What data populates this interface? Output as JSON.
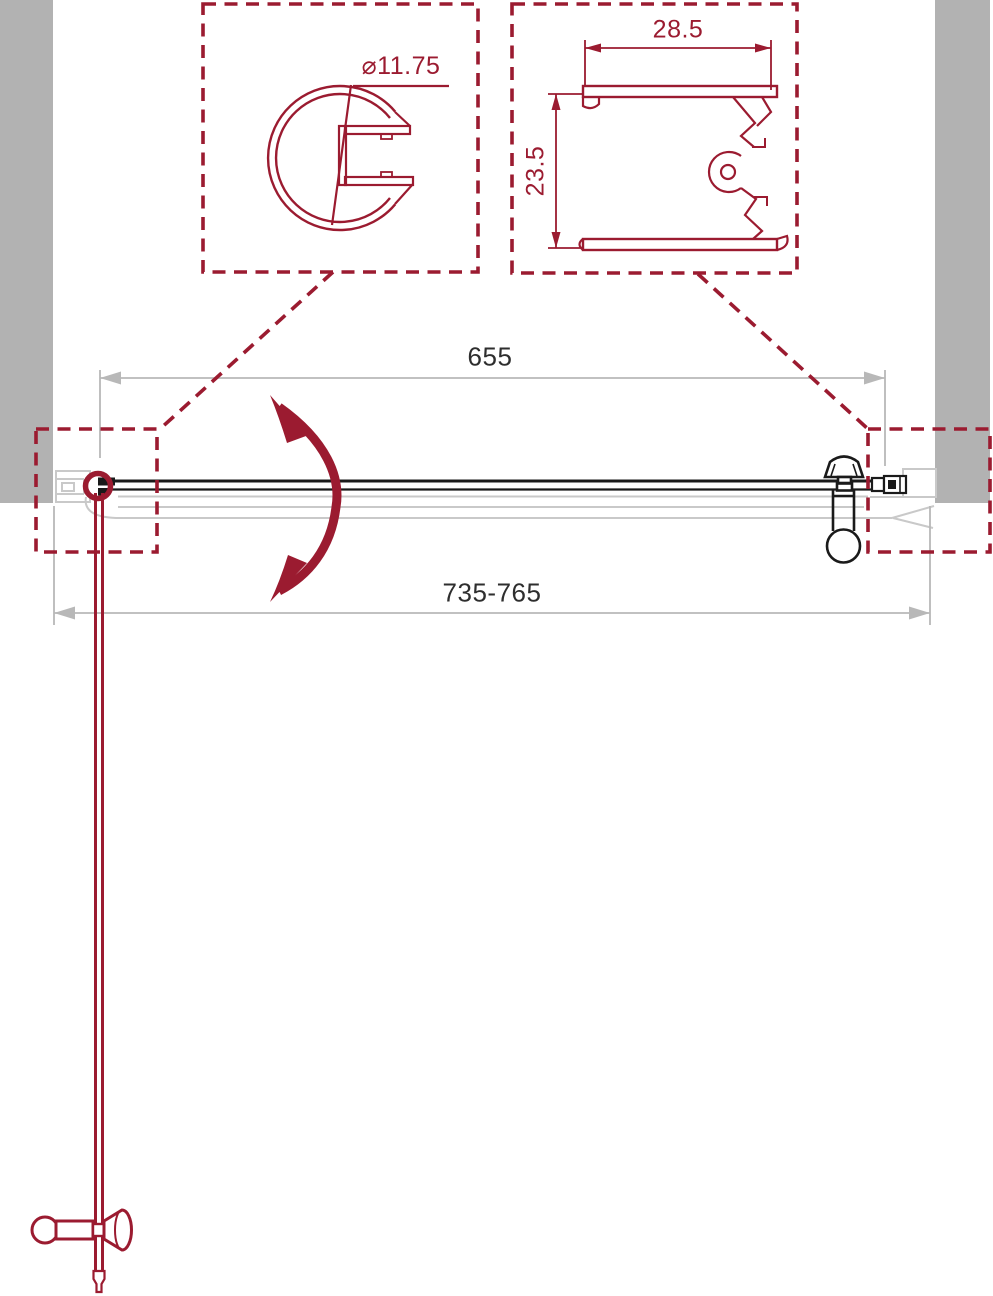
{
  "colors": {
    "accent_red": "#9B1B30",
    "wall_gray": "#B2B2B2",
    "ghost_gray": "#C9C9C9",
    "dimension_gray": "#B8B8B8",
    "line_black": "#1A1A1A",
    "dim_text": "#2E2E2E"
  },
  "details": {
    "knob_profile": {
      "diameter_label": "⌀11.75"
    },
    "wall_profile": {
      "width_label": "28.5",
      "height_label": "23.5"
    }
  },
  "plan": {
    "glass_width_label": "655",
    "opening_width_label": "735-765"
  }
}
